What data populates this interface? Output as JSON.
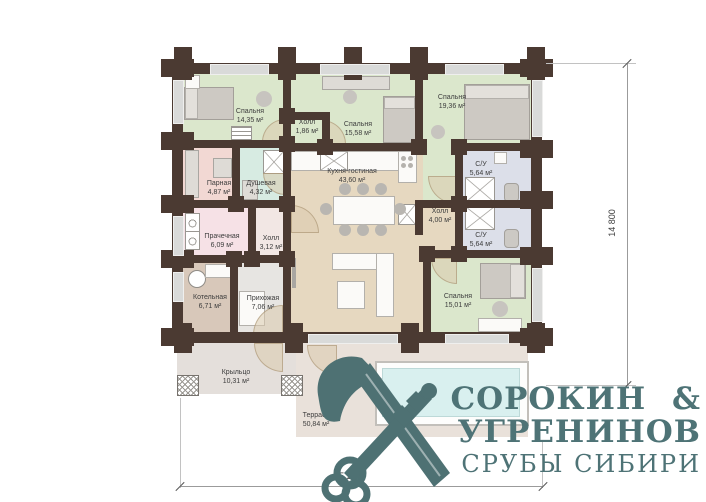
{
  "logo": {
    "line1": "СОРОКИН &",
    "line2": "УГРЕНИНОВ",
    "line3": "СРУБЫ СИБИРИ",
    "color": "#4e7376",
    "icon": "crossed-axe-and-key"
  },
  "dimensions": {
    "vertical": "14 800",
    "horizontal": "15 200"
  },
  "palette": {
    "wall": "#4b3a32",
    "bedroom_floor": "#dbe7cc",
    "kitchen_floor": "#e6d8c0",
    "sauna_floor": "#f2d8d3",
    "shower_floor": "#d7ebe2",
    "laundry_floor": "#f6e1e6",
    "hall2_floor": "#f2e7e4",
    "boiler_floor": "#d8c8ba",
    "entry_floor": "#e7e5e2",
    "bathroom_floor": "#dcdfe9",
    "porch_floor": "#e4dfdb",
    "terrace_floor": "#e9e1da",
    "pool_water": "#d9f0ef",
    "logo_teal": "#4e7376"
  },
  "rooms": [
    {
      "name": "bedroom-1",
      "label": "Спальня",
      "area": "14,35 м²"
    },
    {
      "name": "hall-small",
      "label": "Холл",
      "area": "1,86 м²"
    },
    {
      "name": "bedroom-2",
      "label": "Спальня",
      "area": "15,58 м²"
    },
    {
      "name": "bedroom-3",
      "label": "Спальня",
      "area": "19,36 м²"
    },
    {
      "name": "bathroom-1",
      "label": "С/У",
      "area": "5,64 м²"
    },
    {
      "name": "sauna",
      "label": "Парная",
      "area": "4,87 м²"
    },
    {
      "name": "shower-room",
      "label": "Душевая",
      "area": "4,32 м²"
    },
    {
      "name": "kitchen-living",
      "label": "Кухня-гостиная",
      "area": "43,60 м²"
    },
    {
      "name": "laundry",
      "label": "Прачечная",
      "area": "6,09 м²"
    },
    {
      "name": "hall-2",
      "label": "Холл",
      "area": "3,12 м²"
    },
    {
      "name": "boiler-room",
      "label": "Котельная",
      "area": "6,71 м²"
    },
    {
      "name": "entryway",
      "label": "Прихожая",
      "area": "7,06 м²"
    },
    {
      "name": "hall-3",
      "label": "Холл",
      "area": "4,00 м²"
    },
    {
      "name": "bathroom-2",
      "label": "С/У",
      "area": "5,64 м²"
    },
    {
      "name": "bedroom-4",
      "label": "Спальня",
      "area": "15,01 м²"
    },
    {
      "name": "porch",
      "label": "Крыльцо",
      "area": "10,31 м²"
    },
    {
      "name": "terrace",
      "label": "Терраса",
      "area": "50,84 м²"
    }
  ]
}
